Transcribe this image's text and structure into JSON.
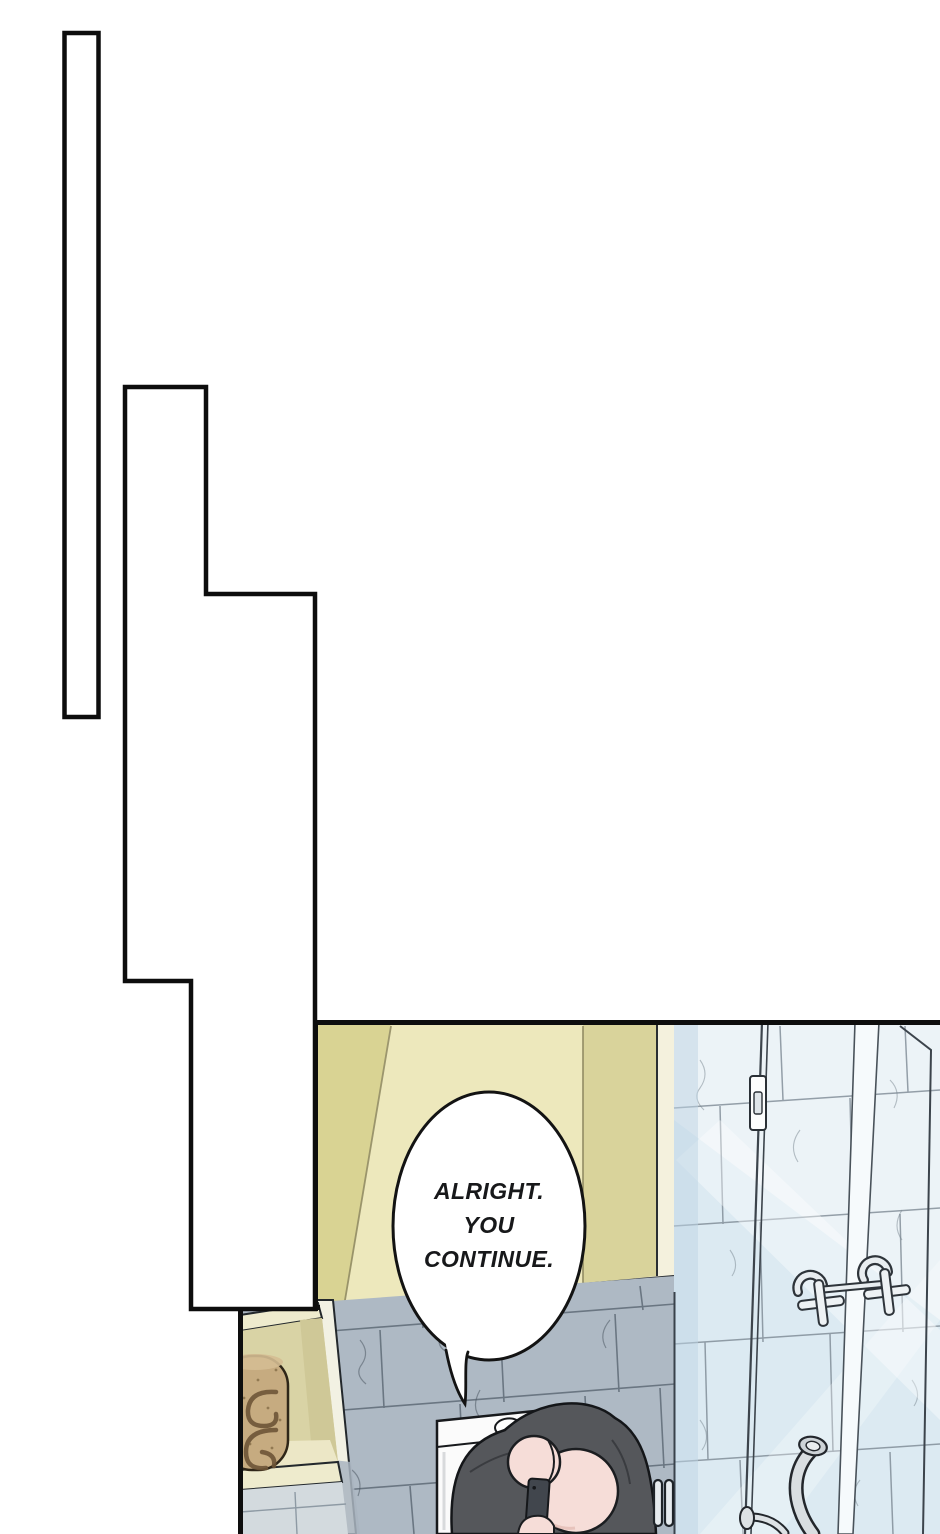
{
  "page": {
    "kind": "comic-page",
    "background": "#ffffff",
    "panel_count": 3
  },
  "speech_bubble": {
    "lines": [
      "ALRIGHT.",
      "YOU",
      "CONTINUE."
    ],
    "fill": "#ffffff",
    "stroke": "#131313",
    "text_color": "#17181a"
  },
  "colors": {
    "panel_border": "#0d0d0d",
    "cabinet_left_sliver": "#d9d393",
    "cabinet_mid": "#ede8bc",
    "cabinet_right": "#d9d39b",
    "trim_cream": "#f4f1dd",
    "tile_dark_base": "#aeb9c4",
    "tile_dark_grout": "#5f6b77",
    "tile_light_base": "#ecf3f7",
    "tile_light_grout": "#7d8994",
    "glass_tint": "#cfe2ee",
    "glass_strip": "#f6fafc",
    "niche_wall": "#d9d3a5",
    "niche_wall_shade": "#cfc897",
    "niche_floor": "#ece7c6",
    "niche_band": "#eeebcd",
    "below_niche_tile": "#d3dade",
    "towel": "#c6ab80",
    "towel_line": "#6e5537",
    "towel_top": "#d4bc92",
    "toilet_white": "#fbfbfb",
    "clothes_gray": "#55575b",
    "skin_pink": "#f6ddd8",
    "phone_dark": "#41464d",
    "metal_light": "#d9dee1",
    "metal_flange": "#cdd3d7",
    "fixture_fill": "#eef2f4",
    "outline_dark": "#17191c"
  },
  "scene_objects": [
    "empty-panel",
    "stepped-empty-panel",
    "bathroom-panel",
    "speech-bubble",
    "wall-cabinet",
    "tile-wall",
    "shower-glass-panel",
    "glass-hinge",
    "faucet-cross-handle",
    "shower-hook",
    "door-handle",
    "wall-niche",
    "towel-roll",
    "toilet-tank",
    "flush-button",
    "person",
    "phone",
    "grab-bar-pipe"
  ]
}
